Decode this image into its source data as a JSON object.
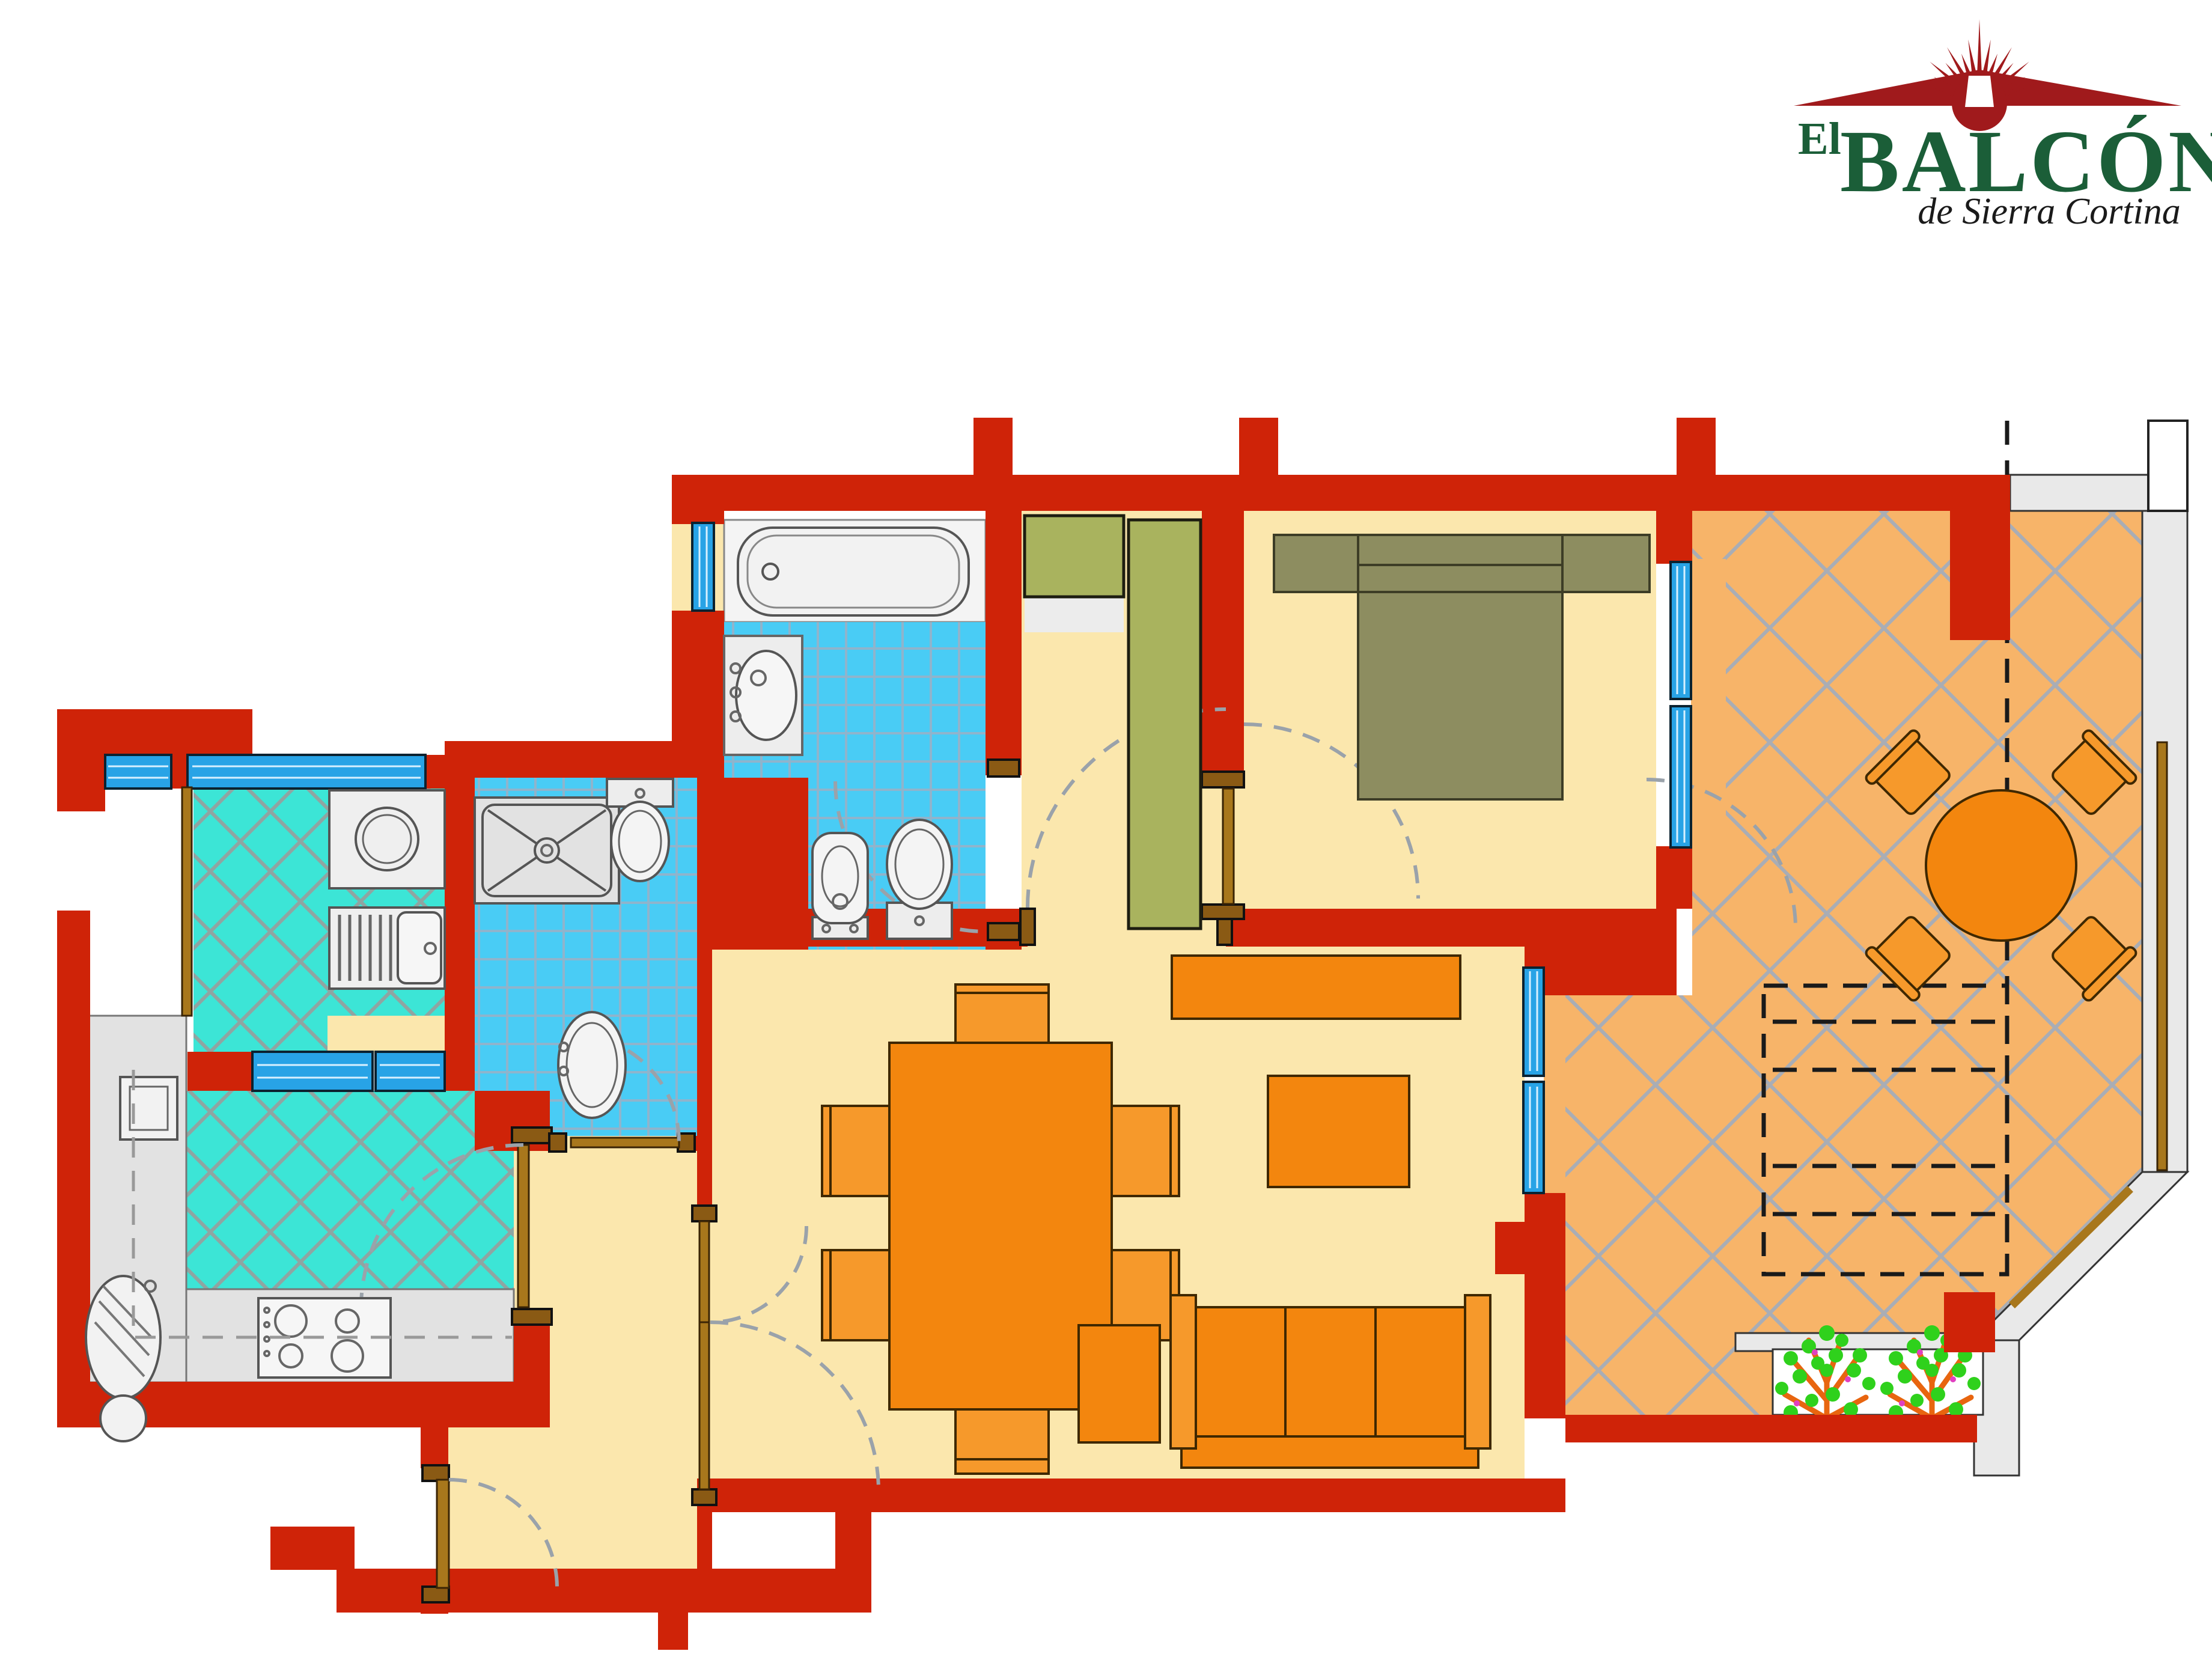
{
  "logo": {
    "el": "El",
    "name": "BALCÓN",
    "tagline": "de Sierra Cortina"
  },
  "colors": {
    "wall-red": "#cf2308",
    "floor-cream": "#fbe7ad",
    "terrace-orange": "#f7b469",
    "furn-orange": "#f3860e",
    "bed-olive": "#8d8d60",
    "ward-green": "#a9b35e",
    "tile-cyan": "#3ce5d6",
    "tile-blue": "#49ccf5",
    "window-blue": "#28a3e6",
    "rail-gray": "#e9e9e9",
    "wood": "#a8771c",
    "logo-green": "#1b5e38",
    "logo-red": "#a01a1c",
    "plant-green": "#2fd11c",
    "plant-branch": "#e8650f"
  },
  "plan": {
    "type": "apartment-floor-plan",
    "rooms": [
      {
        "name": "main-bathroom",
        "fixtures": [
          "bathtub",
          "washbasin-vanity",
          "bidet",
          "toilet",
          "window"
        ]
      },
      {
        "name": "shower-bathroom",
        "fixtures": [
          "shower-tray",
          "toilet",
          "pedestal-sink"
        ]
      },
      {
        "name": "laundry-gallery",
        "fixtures": [
          "washing-machine",
          "drainboard-sink",
          "windows"
        ]
      },
      {
        "name": "kitchen",
        "fixtures": [
          "counter",
          "double-sink",
          "hob",
          "water-heater",
          "windows"
        ]
      },
      {
        "name": "entrance-hall",
        "fixtures": [
          "entry-door"
        ]
      },
      {
        "name": "corridor",
        "fixtures": [
          "wardrobe",
          "wardrobe-tall"
        ]
      },
      {
        "name": "bedroom",
        "fixtures": [
          "double-bed",
          "nightstands",
          "window"
        ]
      },
      {
        "name": "living-dining-room",
        "fixtures": [
          "dining-table",
          "six-chairs",
          "sideboard",
          "coffee-table",
          "pouf",
          "sofa",
          "window"
        ]
      },
      {
        "name": "terrace",
        "fixtures": [
          "round-table",
          "four-chairs",
          "planter",
          "railing",
          "pergola-dashed"
        ]
      }
    ]
  }
}
